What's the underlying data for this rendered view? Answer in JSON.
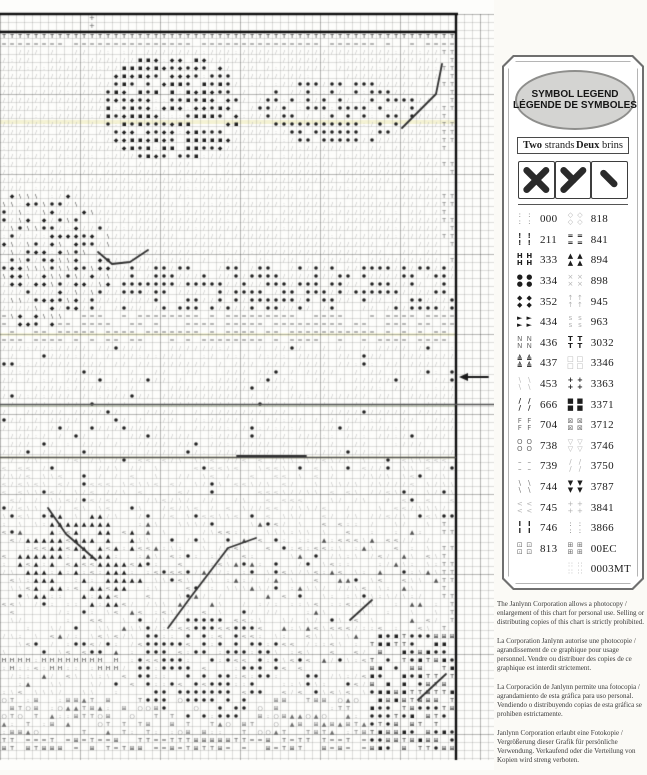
{
  "legend": {
    "title_en": "SYMBOL LEGEND",
    "title_fr": "LÉGENDE DE SYMBOLES",
    "strands": {
      "en_bold": "Two",
      "en_rest": " strands",
      "fr_bold": "Deux",
      "fr_rest": " brins"
    },
    "stitch_types": [
      "full-cross-stitch",
      "three-quarter-stitch",
      "half-stitch"
    ],
    "left": [
      {
        "code": "000",
        "glyph": ":",
        "shade": "medium"
      },
      {
        "code": "211",
        "glyph": "!",
        "shade": "dark"
      },
      {
        "code": "333",
        "glyph": "H",
        "shade": "dark"
      },
      {
        "code": "334",
        "glyph": "●",
        "shade": "dark"
      },
      {
        "code": "352",
        "glyph": "◆",
        "shade": "dark"
      },
      {
        "code": "434",
        "glyph": "►",
        "shade": "dark"
      },
      {
        "code": "436",
        "glyph": "N",
        "shade": "medium"
      },
      {
        "code": "437",
        "glyph": "≜",
        "shade": "dark"
      },
      {
        "code": "453",
        "glyph": "\\",
        "shade": "light"
      },
      {
        "code": "666",
        "glyph": "/",
        "shade": "dark"
      },
      {
        "code": "704",
        "glyph": "F",
        "shade": "medium"
      },
      {
        "code": "738",
        "glyph": "O",
        "shade": "medium"
      },
      {
        "code": "739",
        "glyph": "–",
        "shade": "medium"
      },
      {
        "code": "744",
        "glyph": "\\",
        "shade": "medium"
      },
      {
        "code": "745",
        "glyph": "<",
        "shade": "light"
      },
      {
        "code": "746",
        "glyph": "I",
        "shade": "dark"
      },
      {
        "code": "813",
        "glyph": "⊡",
        "shade": "medium"
      }
    ],
    "right": [
      {
        "code": "818",
        "glyph": "◇",
        "shade": "light"
      },
      {
        "code": "841",
        "glyph": "=",
        "shade": "dark"
      },
      {
        "code": "894",
        "glyph": "▲",
        "shade": "dark"
      },
      {
        "code": "898",
        "glyph": "×",
        "shade": "light"
      },
      {
        "code": "945",
        "glyph": "↑",
        "shade": "light"
      },
      {
        "code": "963",
        "glyph": "s",
        "shade": "light"
      },
      {
        "code": "3032",
        "glyph": "T",
        "shade": "dark"
      },
      {
        "code": "3346",
        "glyph": "□",
        "shade": "light"
      },
      {
        "code": "3363",
        "glyph": "+",
        "shade": "dark"
      },
      {
        "code": "3371",
        "glyph": "■",
        "shade": "dark"
      },
      {
        "code": "3712",
        "glyph": "⊠",
        "shade": "medium"
      },
      {
        "code": "3746",
        "glyph": "▽",
        "shade": "light"
      },
      {
        "code": "3750",
        "glyph": "/",
        "shade": "light"
      },
      {
        "code": "3787",
        "glyph": "▼",
        "shade": "dark"
      },
      {
        "code": "3841",
        "glyph": "+",
        "shade": "light"
      },
      {
        "code": "3866",
        "glyph": ":",
        "shade": "medium"
      },
      {
        "code": "00EC",
        "glyph": "⊞",
        "shade": "medium"
      },
      {
        "code": "0003MT",
        "glyph": "∷",
        "shade": "light"
      }
    ]
  },
  "notices": [
    "The Janlynn Corporation allows a photocopy / enlargement of this chart for personal use.  Selling or distributing copies of this chart is strictly prohibited.",
    "La Corporation Janlynn autorise une photocopie / agrandissement de ce graphique pour usage personnel. Vendre ou distribuer des copies de ce graphique est interdit strictement.",
    "La Corporación de Janlynn permite una fotocopia / agrandamiento de esta gráfica para uso personal. Vendiendo o distribuyendo copias de esta gráfica se prohiben estrictamente.",
    "Janlynn Corporation erlaubt eine Fotokopie / Vergrößerung dieser Grafik für persönliche Verwendung. Verkaufend oder die Verteilung von Kopien wird streng verboten."
  ],
  "chart": {
    "cell": 8,
    "width": 494,
    "height": 770,
    "pattern_right_x": 456,
    "top_rule_y": 14,
    "pattern_top_y": 32,
    "pattern_bottom_y": 760,
    "center_arrow_y": 377,
    "colors": {
      "dark": "#1f1f1f",
      "medium": "#707070",
      "light": "#b9b9b9",
      "border": "#0f0f0f"
    }
  }
}
